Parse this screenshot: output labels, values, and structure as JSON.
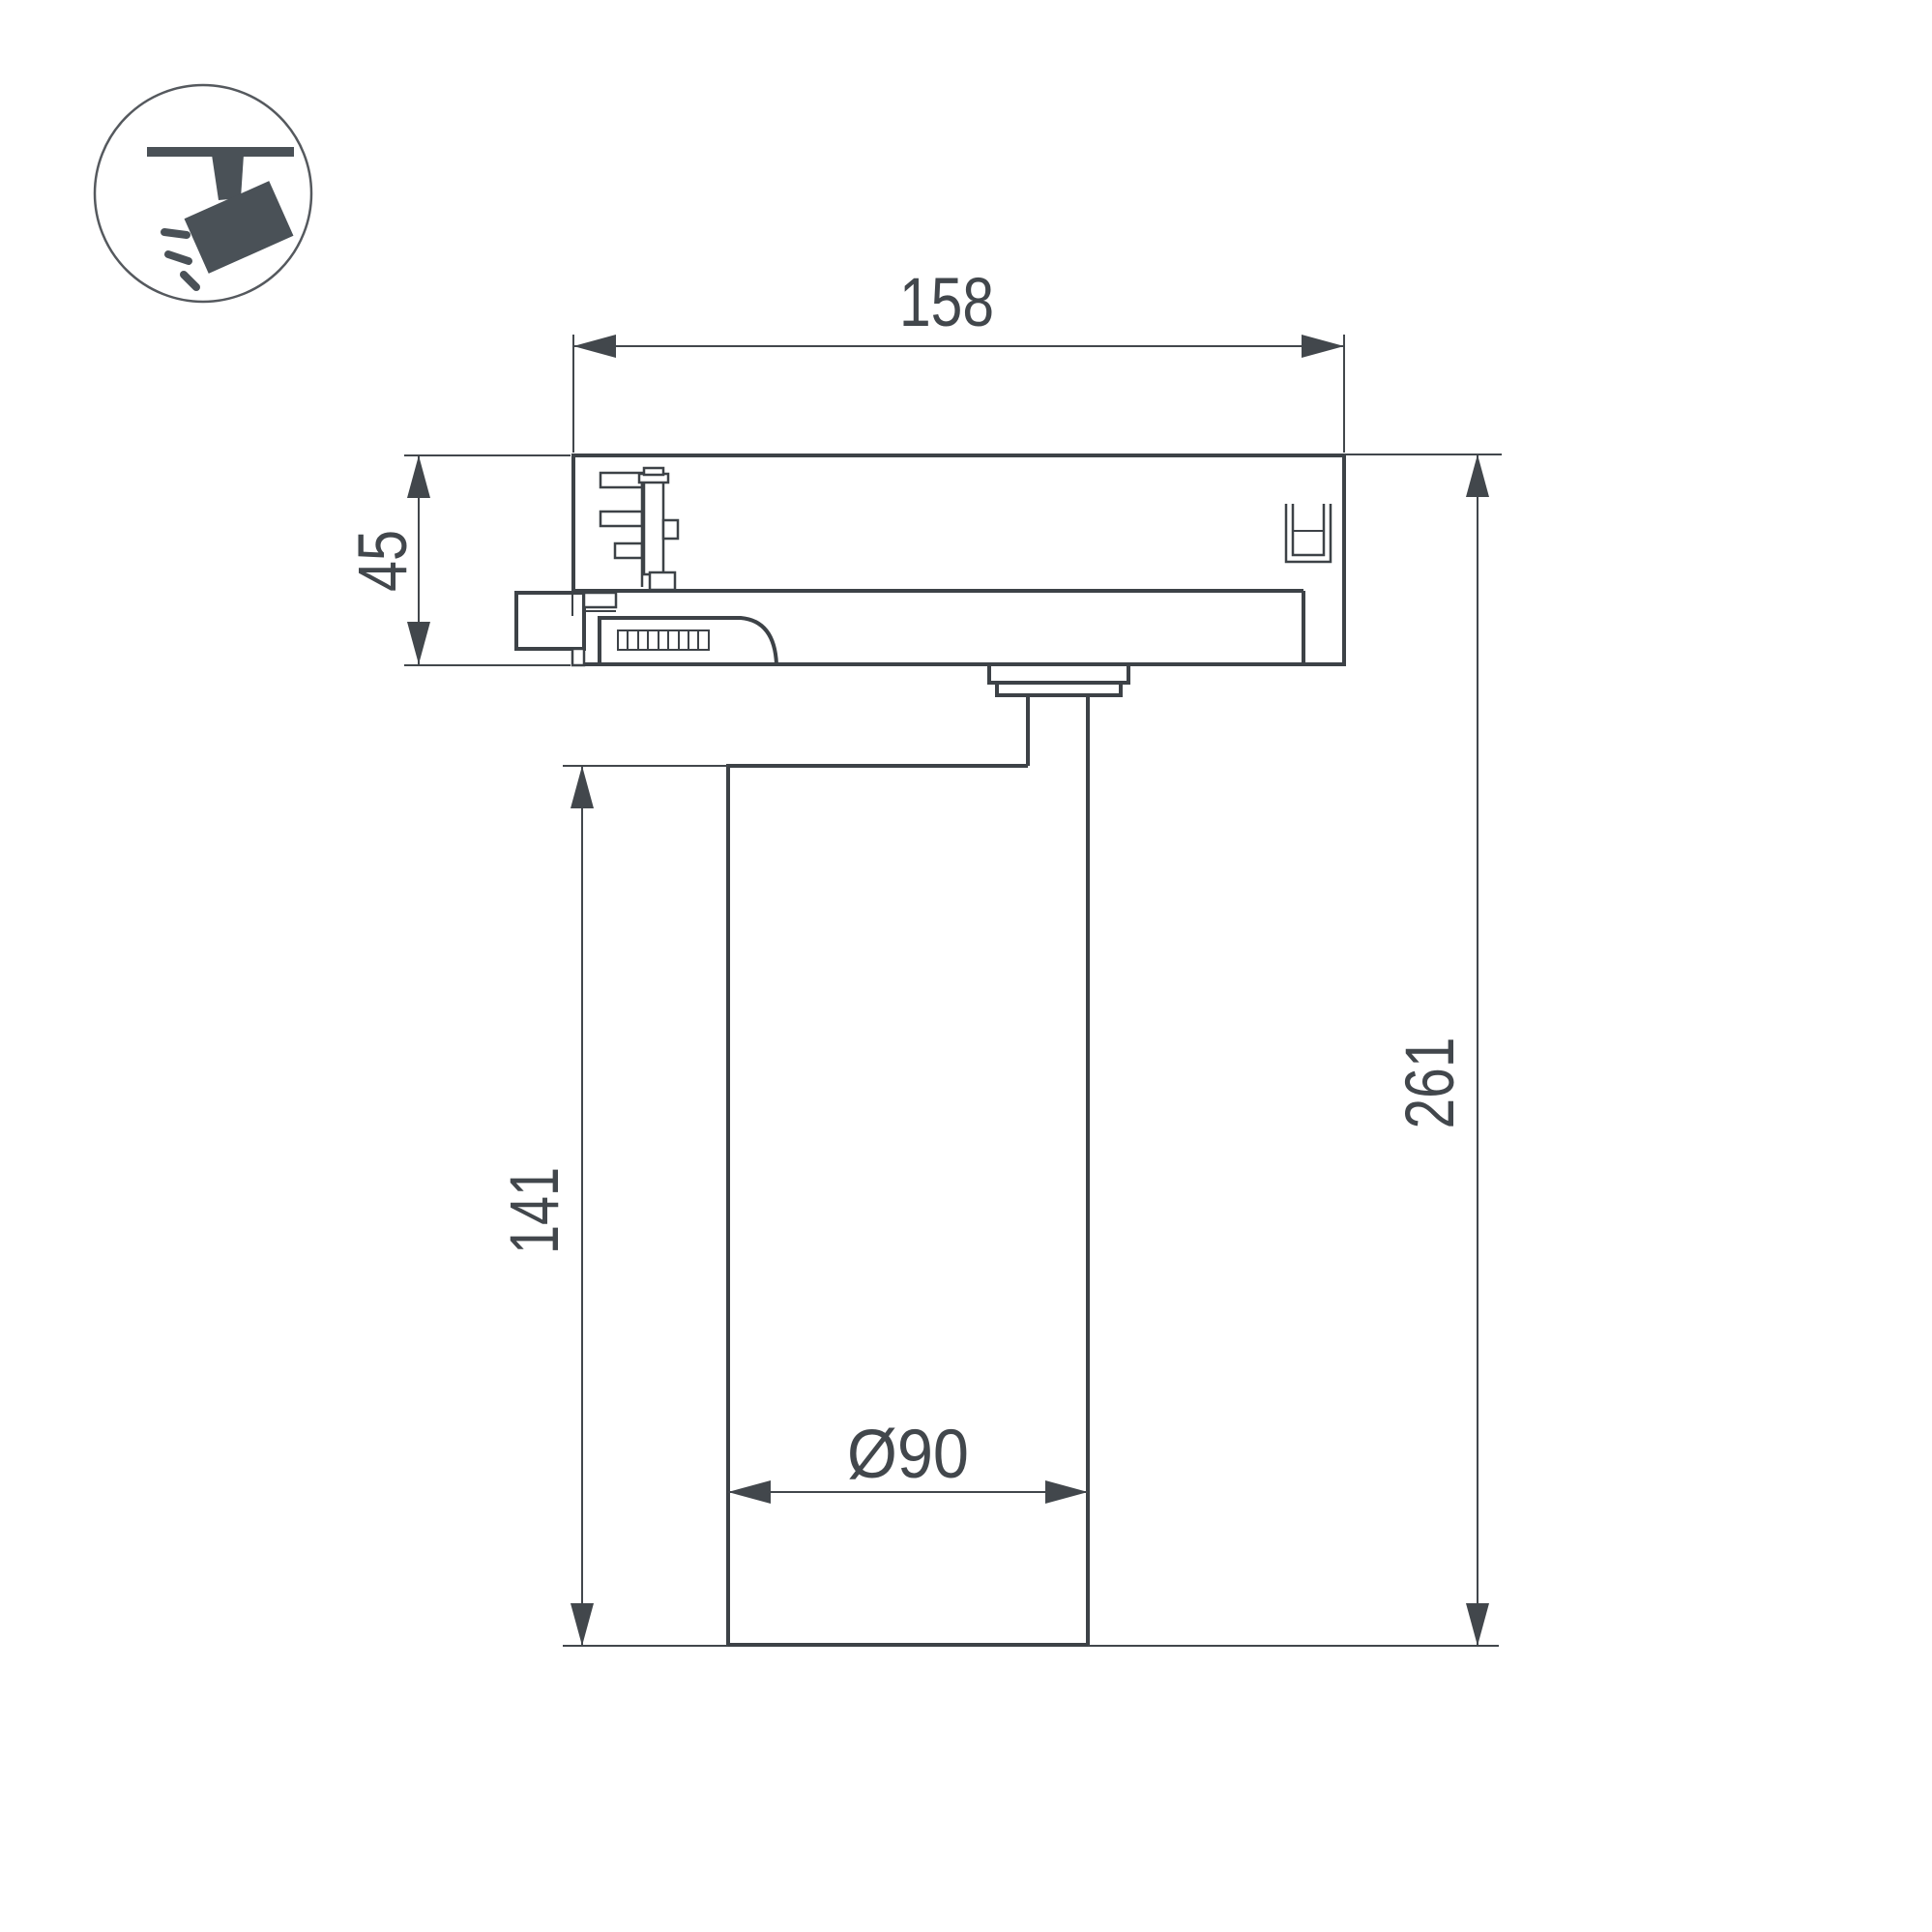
{
  "colors": {
    "background": "#ffffff",
    "line": "#3d4247",
    "dimension": "#42474c",
    "icon": "#4a5157",
    "icon_ring": "#55595e"
  },
  "icon": {
    "name": "track-spotlight"
  },
  "dimensions": {
    "adapter_width": "158",
    "adapter_height": "45",
    "body_height": "141",
    "total_height": "261",
    "body_diameter": "Ø90"
  }
}
